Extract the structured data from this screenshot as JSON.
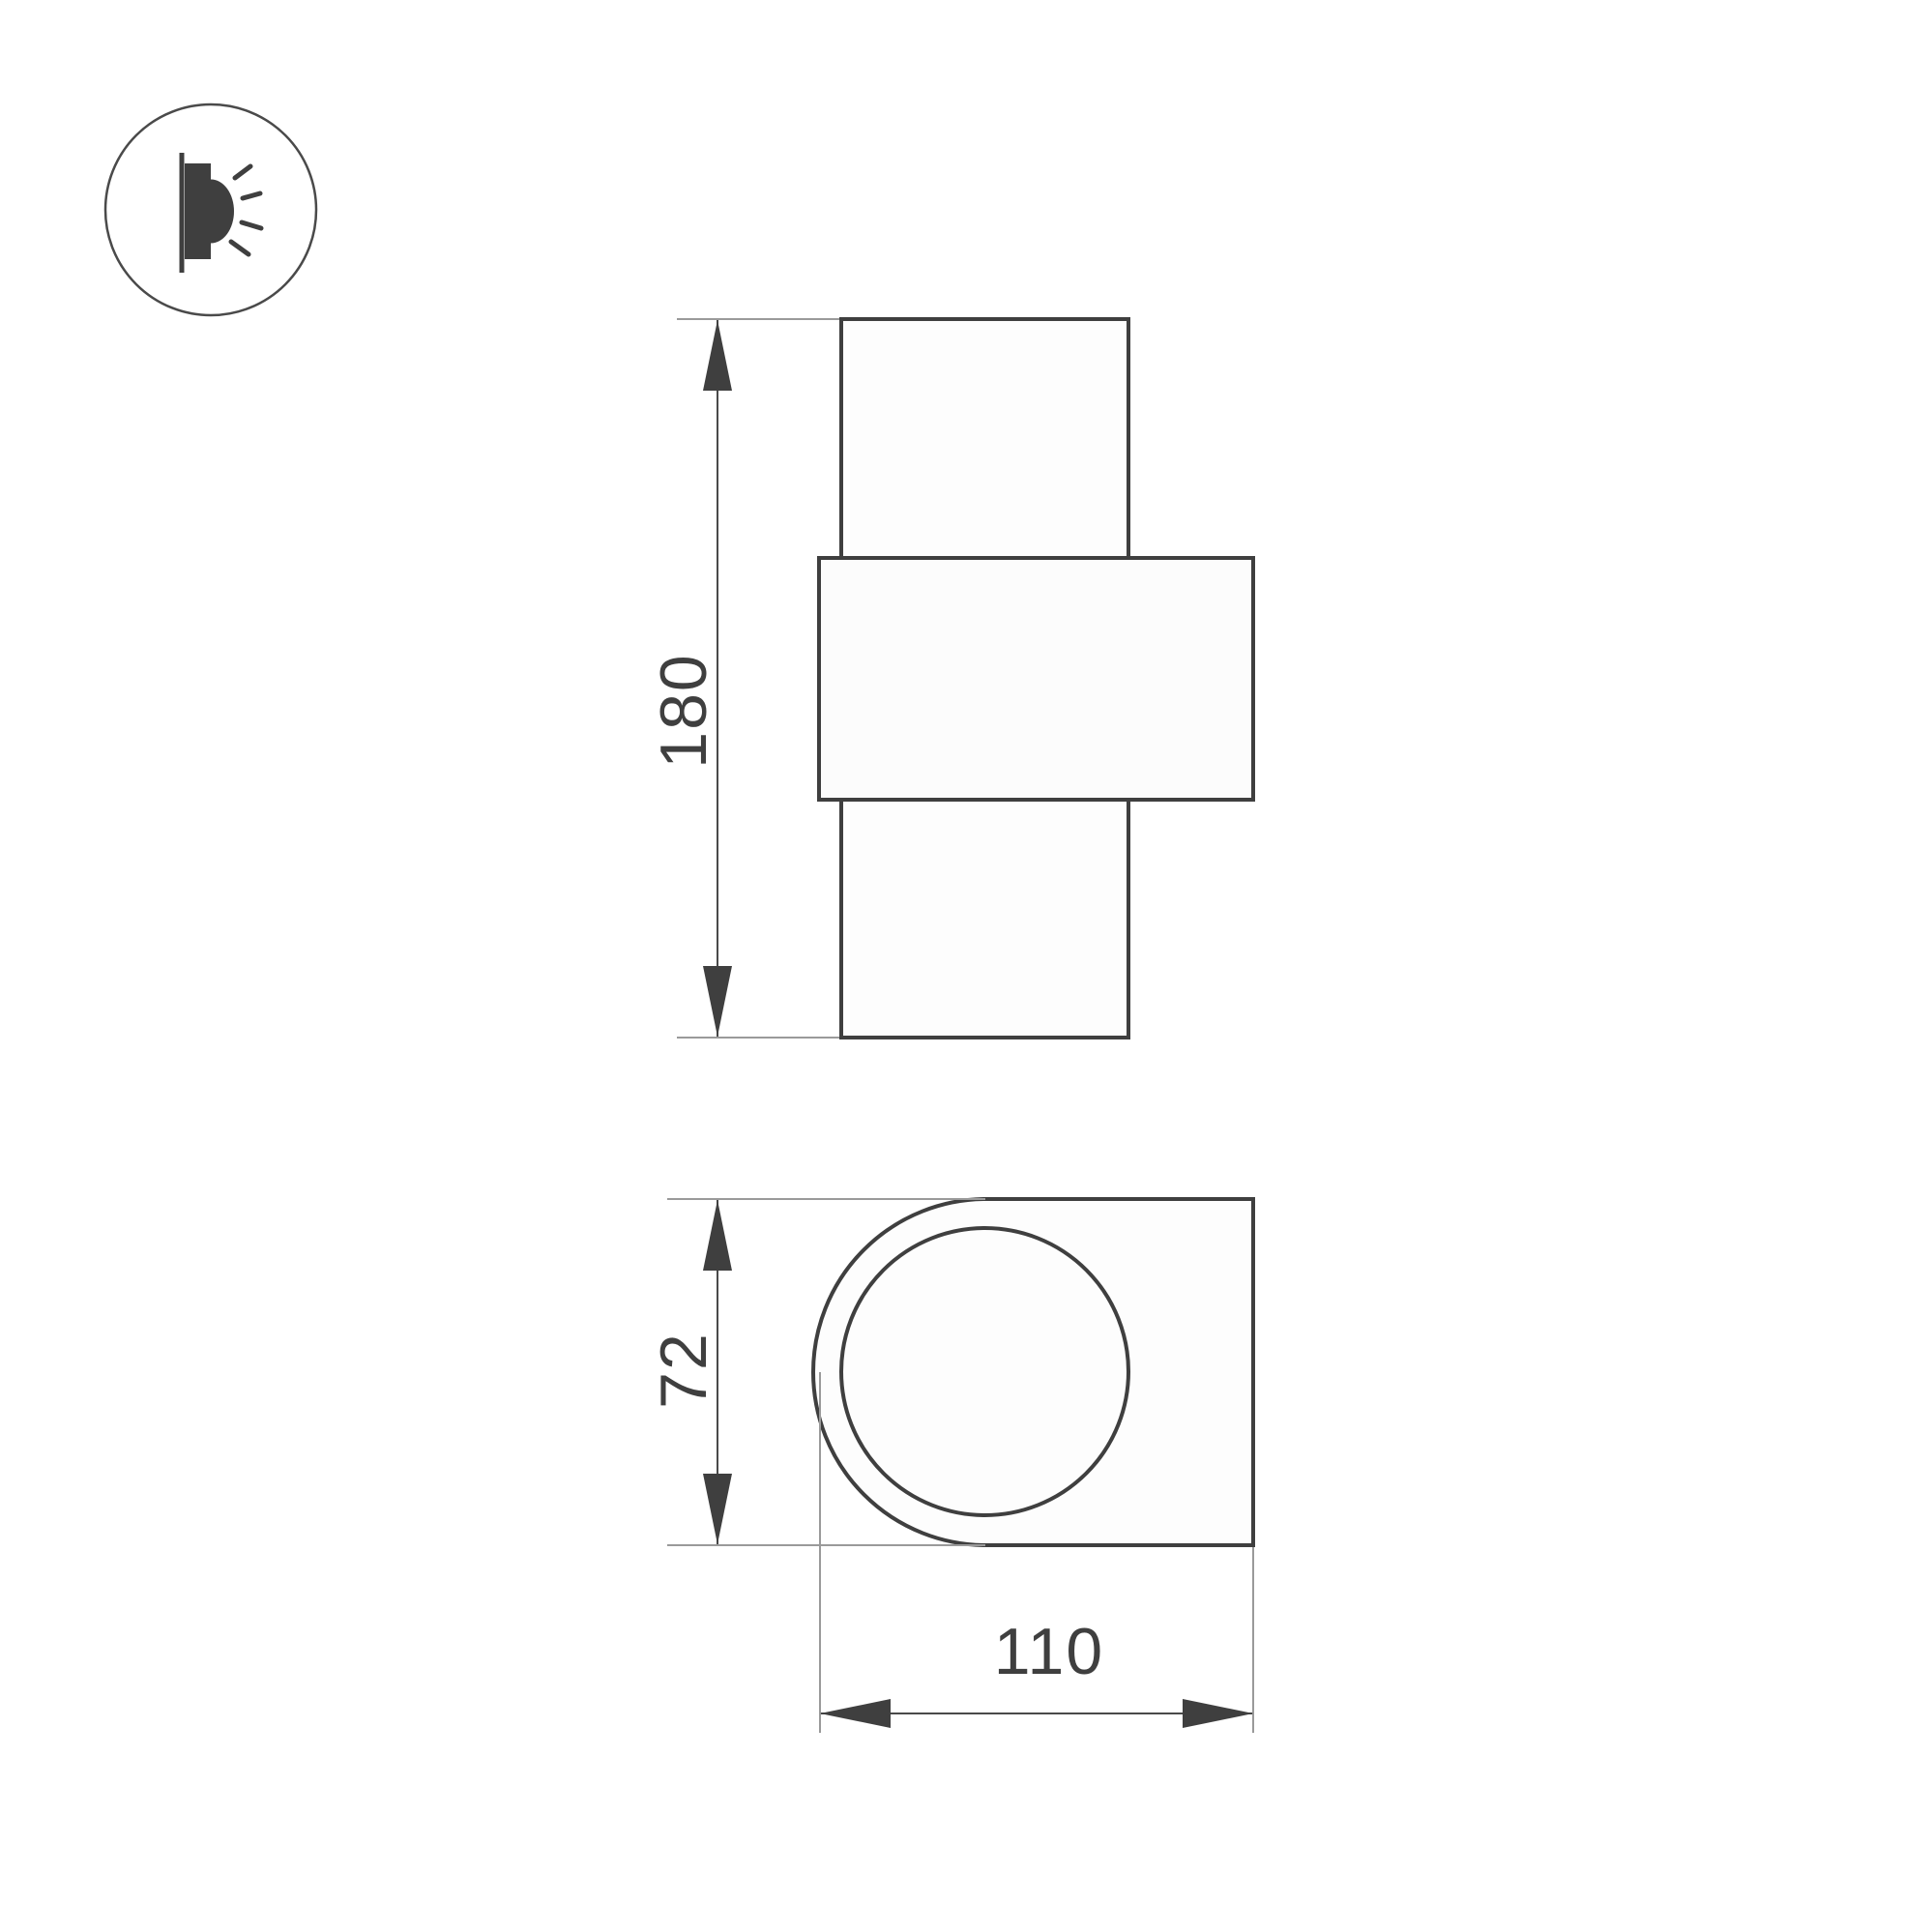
{
  "icon": {
    "name": "wall-mounted-lamp-side-emission",
    "description": "wall light emitting to the side"
  },
  "views": {
    "front": {
      "height_dim": {
        "label": "180"
      }
    },
    "bottom": {
      "depth_dim": {
        "label": "72"
      },
      "width_dim": {
        "label": "110"
      }
    }
  },
  "colors": {
    "outline": "#3f3f3f",
    "dimension": "#4a4a4a",
    "extension": "#9a9a9a",
    "text": "#3f3f3f",
    "background": "#ffffff"
  }
}
